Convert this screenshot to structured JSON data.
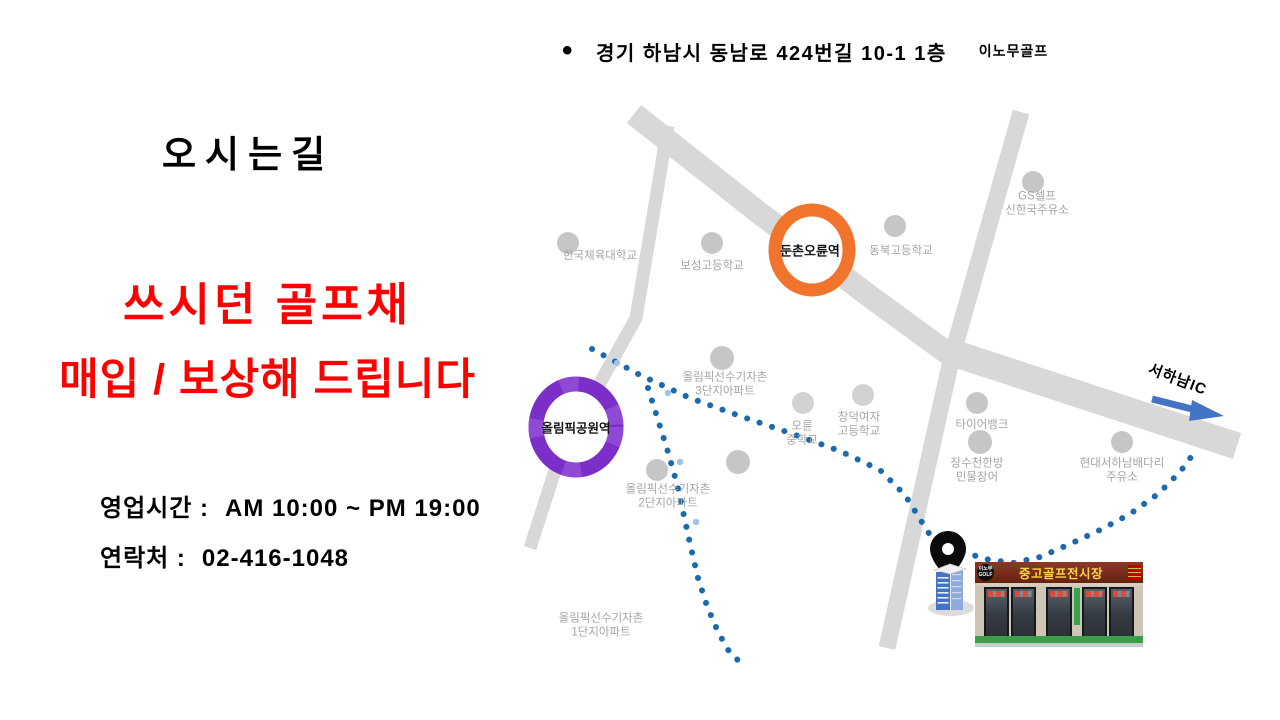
{
  "header": {
    "bullet": "•",
    "address": "경기 하남시 동남로 424번길 10-1 1층",
    "brand": "이노무골프"
  },
  "title": "오시는길",
  "promo": {
    "line1": "쓰시던 골프채",
    "line2": "매입 / 보상해 드립니다",
    "color": "#FF0000"
  },
  "info": {
    "hours_label": "영업시간 :",
    "hours_value": "AM 10:00 ~ PM 19:00",
    "phone_label": "연락처 :",
    "phone_value": "02-416-1048"
  },
  "map": {
    "road_color": "#D8D8D8",
    "route_color": "#1C6AAE",
    "route_light_dot_color": "#9DC3E6",
    "arrow_color": "#4472C4",
    "landmark_dot_color": "#C6C6C6",
    "station_orange": {
      "name": "둔촌오륜역",
      "color": "#F0742C"
    },
    "station_purple": {
      "name": "올림픽공원역",
      "color": "#7C2EC8"
    },
    "ic_label": "서하남IC",
    "landmarks": [
      {
        "name": "한국체육대학교"
      },
      {
        "name": "보성고등학교"
      },
      {
        "name": "동북고등학교"
      },
      {
        "name": "GS셀프\n신한국주유소"
      },
      {
        "name": "올림픽선수기자촌\n3단지아파트"
      },
      {
        "name": "오륜\n중학교"
      },
      {
        "name": "창덕여자\n고등학교"
      },
      {
        "name": "타이어뱅크"
      },
      {
        "name": "장수천한방\n민물장어"
      },
      {
        "name": "현대서하남배다리\n주유소"
      },
      {
        "name": "올림픽선수기자촌\n2단지아파트"
      },
      {
        "name": "올림픽선수기자촌\n1단지아파트"
      }
    ]
  },
  "store": {
    "logo_top": "이노무",
    "logo_bottom": "GOLF",
    "sign_text": "중고골프전시장"
  }
}
